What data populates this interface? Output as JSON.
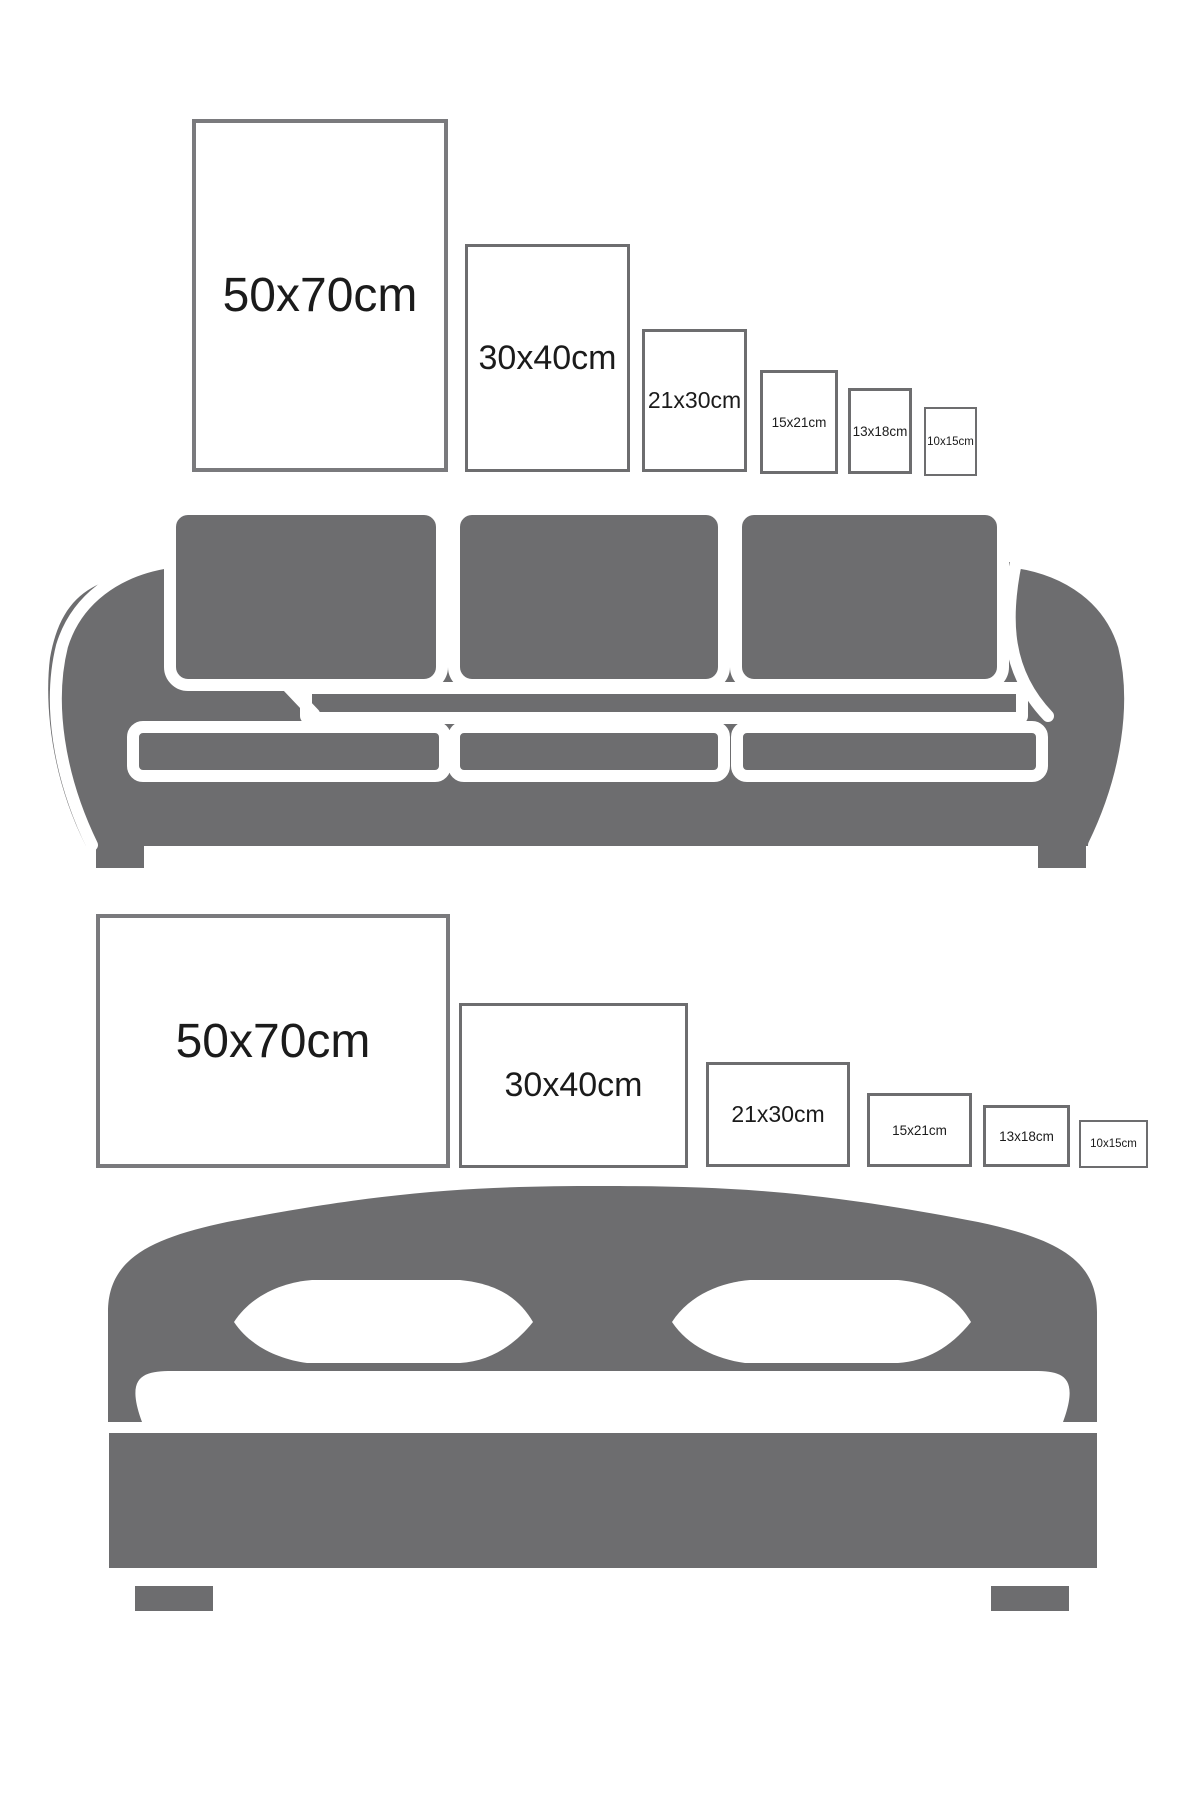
{
  "colors": {
    "furniture_gray": "#6d6d6f",
    "frame_border_large": "#7a7a7d",
    "frame_border_small": "#6d6d6f",
    "label_text": "#1b1b1b",
    "background": "#ffffff"
  },
  "top_section": {
    "furniture": "sofa",
    "orientation": "portrait",
    "frames": [
      {
        "label": "50x70cm"
      },
      {
        "label": "30x40cm"
      },
      {
        "label": "21x30cm"
      },
      {
        "label": "15x21cm"
      },
      {
        "label": "13x18cm"
      },
      {
        "label": "10x15cm"
      }
    ]
  },
  "bottom_section": {
    "furniture": "bed",
    "orientation": "landscape",
    "frames": [
      {
        "label": "50x70cm"
      },
      {
        "label": "30x40cm"
      },
      {
        "label": "21x30cm"
      },
      {
        "label": "15x21cm"
      },
      {
        "label": "13x18cm"
      },
      {
        "label": "10x15cm"
      }
    ]
  }
}
